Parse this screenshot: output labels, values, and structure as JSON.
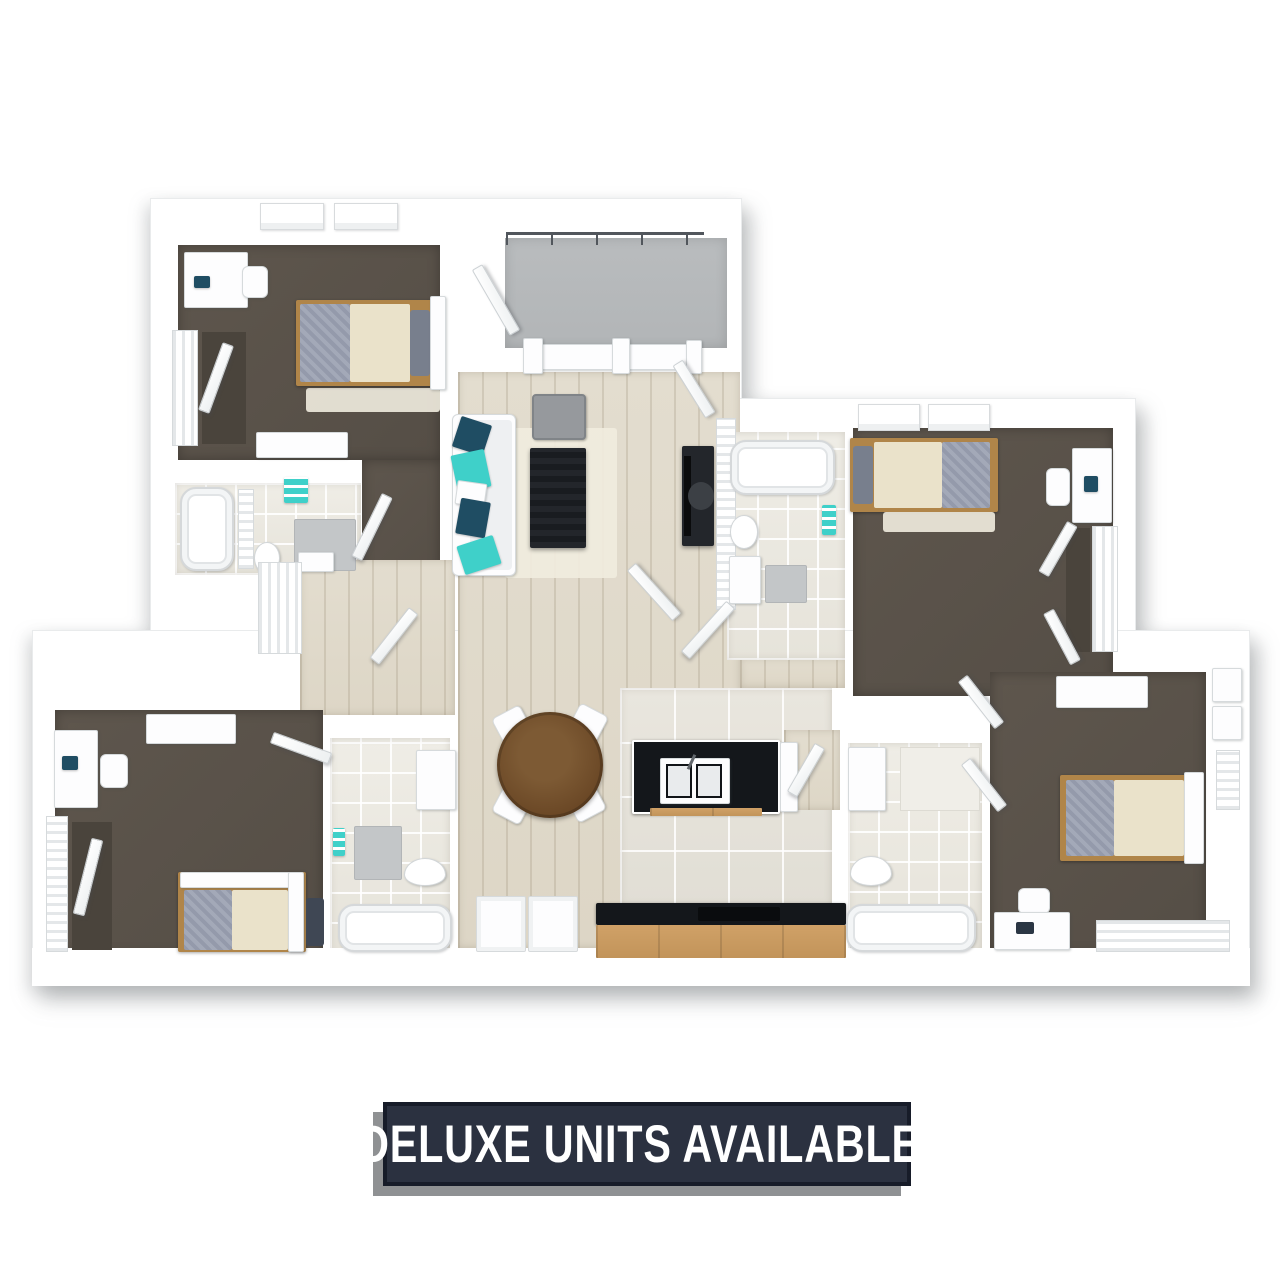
{
  "banner": {
    "label": "DELUXE UNITS AVAILABLE!"
  },
  "palette": {
    "wall": "#ffffff",
    "wall-edge": "#e9ebec",
    "bedroom-floor": "#5e564d",
    "bedroom-floor-2": "#554e46",
    "wood-floor": "#e3ddcf",
    "kitchen-tile": "#e8e5dd",
    "bath-tile": "#edebe4",
    "patio-floor": "#b9bcbe",
    "railing": "#51565c",
    "counter-black": "#14171b",
    "cabinet-wood": "#d0a167",
    "table-wood": "#6b4826",
    "accent-teal": "#3fd0c9",
    "accent-navy": "#1f4d63",
    "bed-cream": "#eae2ca",
    "bed-gray": "#949aab",
    "bed-frame-wood": "#b08549",
    "furniture-dark": "#23262b",
    "banner-bg": "#2b3140",
    "banner-border": "#171c29",
    "banner-shadow": "#8f9193",
    "banner-text": "#ffffff"
  }
}
